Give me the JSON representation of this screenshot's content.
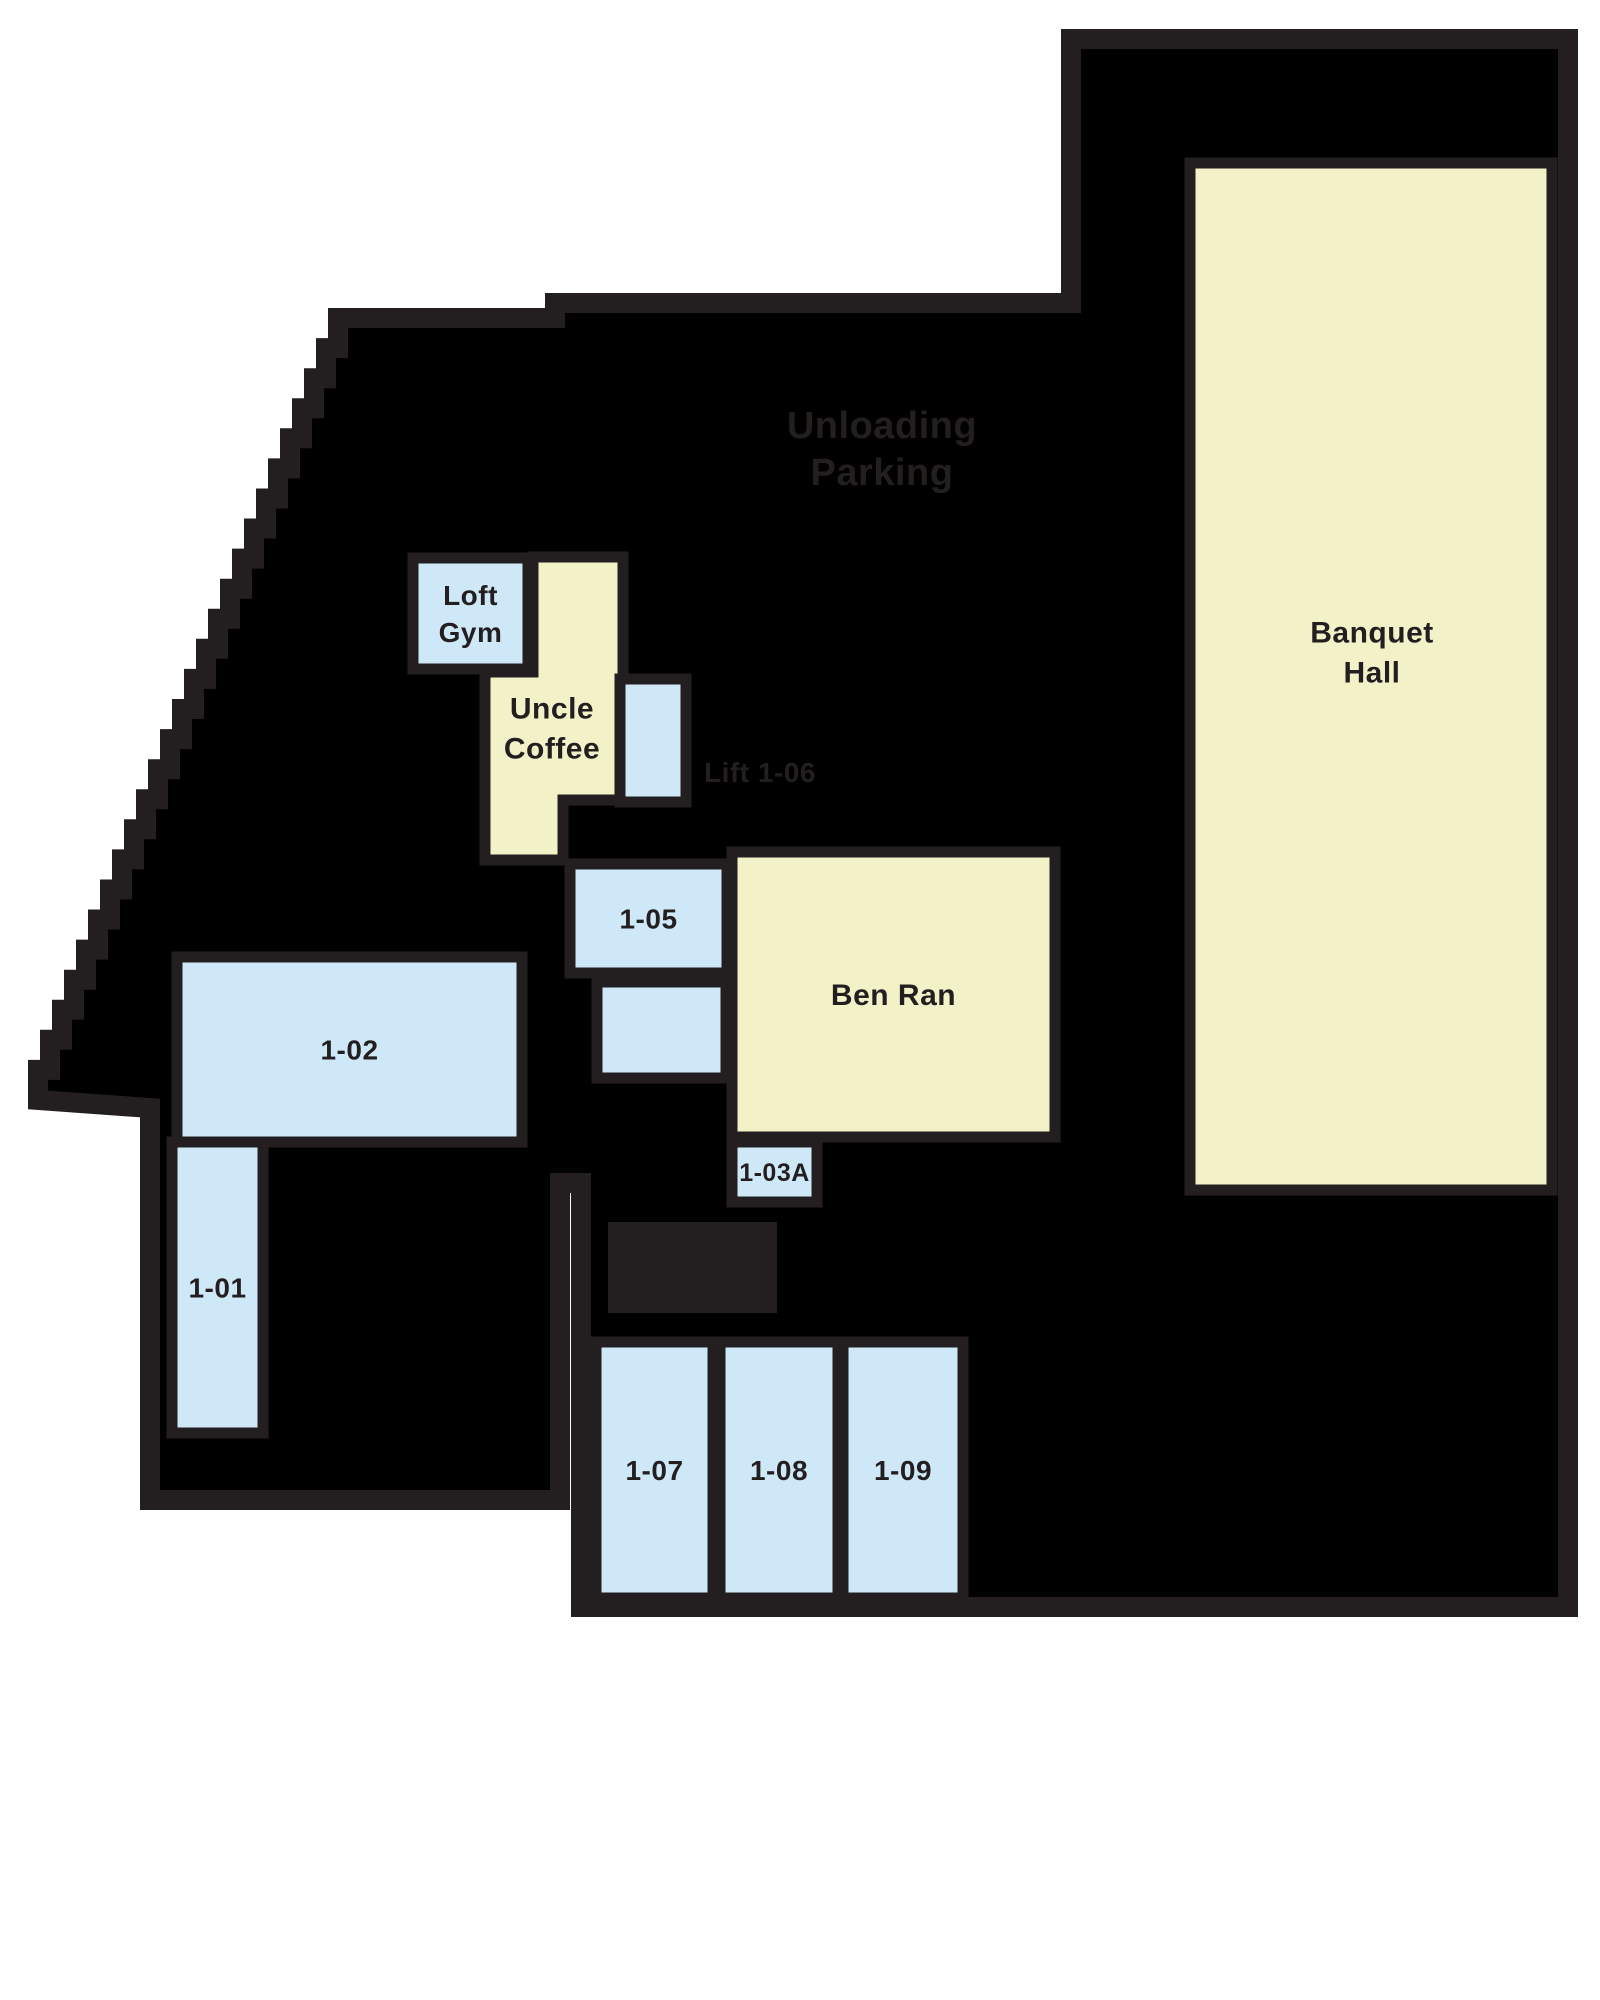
{
  "page": {
    "background": "#ffffff"
  },
  "floorplan": {
    "colors": {
      "wall": "#231f20",
      "interior": "#000000",
      "room_blue": "#cfe8f8",
      "room_yellow": "#f3f1c8",
      "label": "#231f20"
    },
    "rooms": [
      {
        "id": "loft-gym",
        "name": "Loft Gym",
        "lines": [
          "Loft",
          "Gym"
        ],
        "color_key": "room_blue"
      },
      {
        "id": "uncle-coffee",
        "name": "Uncle Coffee",
        "lines": [
          "Uncle",
          "Coffee"
        ],
        "color_key": "room_yellow"
      },
      {
        "id": "unit-1-06",
        "name": "1-06",
        "lines": [],
        "color_key": "room_blue"
      },
      {
        "id": "unit-1-05",
        "name": "1-05",
        "lines": [
          "1-05"
        ],
        "color_key": "room_blue"
      },
      {
        "id": "unit-1-04",
        "name": "",
        "lines": [],
        "color_key": "room_blue"
      },
      {
        "id": "ben-ran",
        "name": "Ben Ran",
        "lines": [
          "Ben Ran"
        ],
        "color_key": "room_yellow"
      },
      {
        "id": "unit-1-03a",
        "name": "1-03A",
        "lines": [
          "1-03A"
        ],
        "color_key": "room_blue"
      },
      {
        "id": "unit-1-02",
        "name": "1-02",
        "lines": [
          "1-02"
        ],
        "color_key": "room_blue"
      },
      {
        "id": "unit-1-01",
        "name": "1-01",
        "lines": [
          "1-01"
        ],
        "color_key": "room_blue"
      },
      {
        "id": "unit-1-07",
        "name": "1-07",
        "lines": [
          "1-07"
        ],
        "color_key": "room_blue"
      },
      {
        "id": "unit-1-08",
        "name": "1-08",
        "lines": [
          "1-08"
        ],
        "color_key": "room_blue"
      },
      {
        "id": "unit-1-09",
        "name": "1-09",
        "lines": [
          "1-09"
        ],
        "color_key": "room_blue"
      },
      {
        "id": "banquet-hall",
        "name": "Banquet Hall",
        "lines": [
          "Banquet",
          "Hall"
        ],
        "color_key": "room_yellow"
      }
    ],
    "zone_labels": [
      {
        "id": "zone-parking",
        "lines": [
          "Unloading",
          "Parking"
        ]
      },
      {
        "id": "zone-lift",
        "lines": [
          "Lift 1-06"
        ]
      }
    ]
  }
}
